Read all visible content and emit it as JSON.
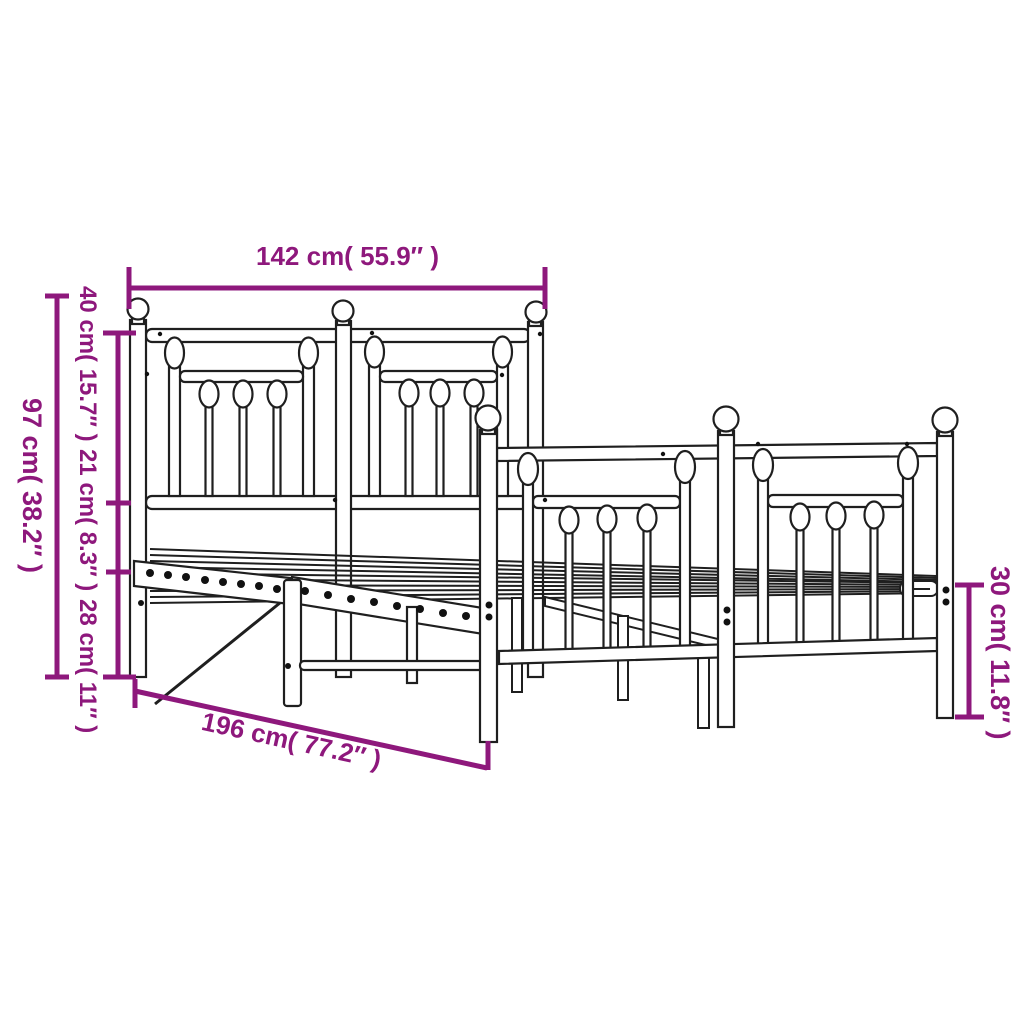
{
  "diagram": {
    "subject": "metal bed frame with headboard and footboard - dimension drawing",
    "labels": {
      "width": "142 cm( 55.9″ )",
      "height_total": "97 cm( 38.2″ )",
      "headboard_top_section": "40 cm( 15.7″ )",
      "headboard_mid_section": "21 cm( 8.3″ )",
      "underbed_height": "28 cm( 11″ )",
      "length": "196 cm( 77.2″ )",
      "footboard_height": "30 cm( 11.8″ )"
    },
    "colors": {
      "dimension_accent": "#8E187C",
      "line_art": "#1F1F1F",
      "background": "#FFFFFF"
    }
  }
}
